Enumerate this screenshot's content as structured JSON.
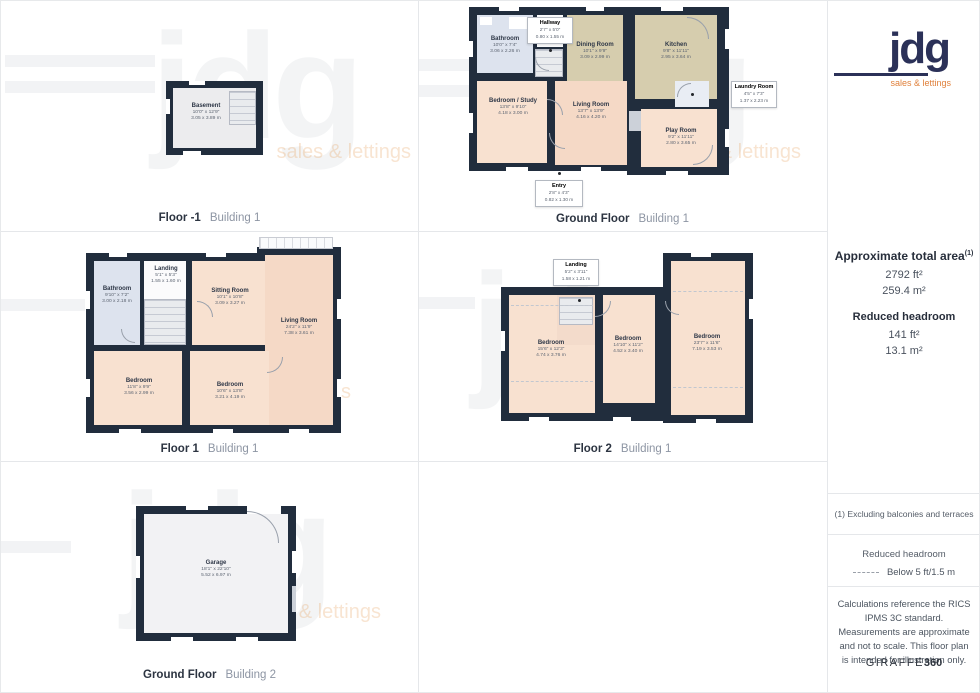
{
  "brand": {
    "name": "jdg",
    "tagline": "sales & lettings"
  },
  "colors": {
    "wall": "#212d3d",
    "room_peach": "#f8e1d0",
    "room_tan": "#d6cdae",
    "room_blue": "#dde3ee",
    "logo_navy": "#2b3158",
    "accent_orange": "#e0813c"
  },
  "plans": {
    "fm1": {
      "floor": "Floor -1",
      "building": "Building 1",
      "rooms": {
        "basement": {
          "name": "Basement",
          "ft": "10'0\" x 12'9\"",
          "m": "3.05 x 3.89 m"
        }
      }
    },
    "gf1": {
      "floor": "Ground Floor",
      "building": "Building 1",
      "rooms": {
        "bathroom": {
          "name": "Bathroom",
          "ft": "10'0\" x 7'4\"",
          "m": "3.06 x 2.26 m"
        },
        "hallway": {
          "name": "Hallway",
          "ft": "2'7\" x 5'0\"",
          "m": "0.80 x 1.55 m"
        },
        "dining": {
          "name": "Dining Room",
          "ft": "10'1\" x 9'9\"",
          "m": "3.09 x 2.99 m"
        },
        "kitchen": {
          "name": "Kitchen",
          "ft": "9'8\" x 11'11\"",
          "m": "2.95 x 3.64 m"
        },
        "laundry": {
          "name": "Laundry Room",
          "ft": "4'5\" x 7'3\"",
          "m": "1.37 x 2.23 m"
        },
        "study": {
          "name": "Bedroom / Study",
          "ft": "13'8\" x 9'10\"",
          "m": "4.18 x 3.00 m"
        },
        "living": {
          "name": "Living Room",
          "ft": "13'7\" x 13'9\"",
          "m": "4.16 x 4.20 m"
        },
        "play": {
          "name": "Play Room",
          "ft": "9'2\" x 11'11\"",
          "m": "2.80 x 3.65 m"
        },
        "entry": {
          "name": "Entry",
          "ft": "2'8\" x 4'3\"",
          "m": "0.82 x 1.30 m"
        }
      }
    },
    "f1": {
      "floor": "Floor 1",
      "building": "Building 1",
      "rooms": {
        "bathroom": {
          "name": "Bathroom",
          "ft": "9'10\" x 7'2\"",
          "m": "3.00 x 2.18 m"
        },
        "landing": {
          "name": "Landing",
          "ft": "5'1\" x 5'3\"",
          "m": "1.55 x 1.60 m"
        },
        "sitting": {
          "name": "Sitting Room",
          "ft": "10'1\" x 10'8\"",
          "m": "3.09 x 3.27 m"
        },
        "living": {
          "name": "Living Room",
          "ft": "24'2\" x 11'9\"",
          "m": "7.38 x 3.61 m"
        },
        "bed1": {
          "name": "Bedroom",
          "ft": "11'8\" x 9'9\"",
          "m": "3.56 x 2.99 m"
        },
        "bed2": {
          "name": "Bedroom",
          "ft": "10'6\" x 13'8\"",
          "m": "3.21 x 4.19 m"
        }
      }
    },
    "f2": {
      "floor": "Floor 2",
      "building": "Building 1",
      "rooms": {
        "landing": {
          "name": "Landing",
          "ft": "5'2\" x 3'11\"",
          "m": "1.58 x 1.21 m"
        },
        "bed1": {
          "name": "Bedroom",
          "ft": "15'6\" x 12'3\"",
          "m": "4.74 x 3.76 m"
        },
        "bed2": {
          "name": "Bedroom",
          "ft": "14'10\" x 11'2\"",
          "m": "4.52 x 3.40 m"
        },
        "bed3": {
          "name": "Bedroom",
          "ft": "23'7\" x 11'6\"",
          "m": "7.19 x 3.53 m"
        }
      }
    },
    "gf2": {
      "floor": "Ground Floor",
      "building": "Building 2",
      "rooms": {
        "garage": {
          "name": "Garage",
          "ft": "18'1\" x 22'10\"",
          "m": "5.52 x 6.97 m"
        }
      }
    }
  },
  "summary": {
    "total_label": "Approximate total area",
    "total_sup": "(1)",
    "total_ft": "2792 ft²",
    "total_m": "259.4 m²",
    "rh_label": "Reduced headroom",
    "rh_ft": "141 ft²",
    "rh_m": "13.1 m²"
  },
  "notes": {
    "note1": "(1) Excluding balconies and terraces",
    "legend_title": "Reduced headroom",
    "legend_text": "Below 5 ft/1.5 m",
    "disclaimer": "Calculations reference the RICS IPMS 3C standard. Measurements are approximate and not to scale. This floor plan is intended for illustration only.",
    "giraffe_plain": "GIRAFFE",
    "giraffe_bold": "360"
  }
}
